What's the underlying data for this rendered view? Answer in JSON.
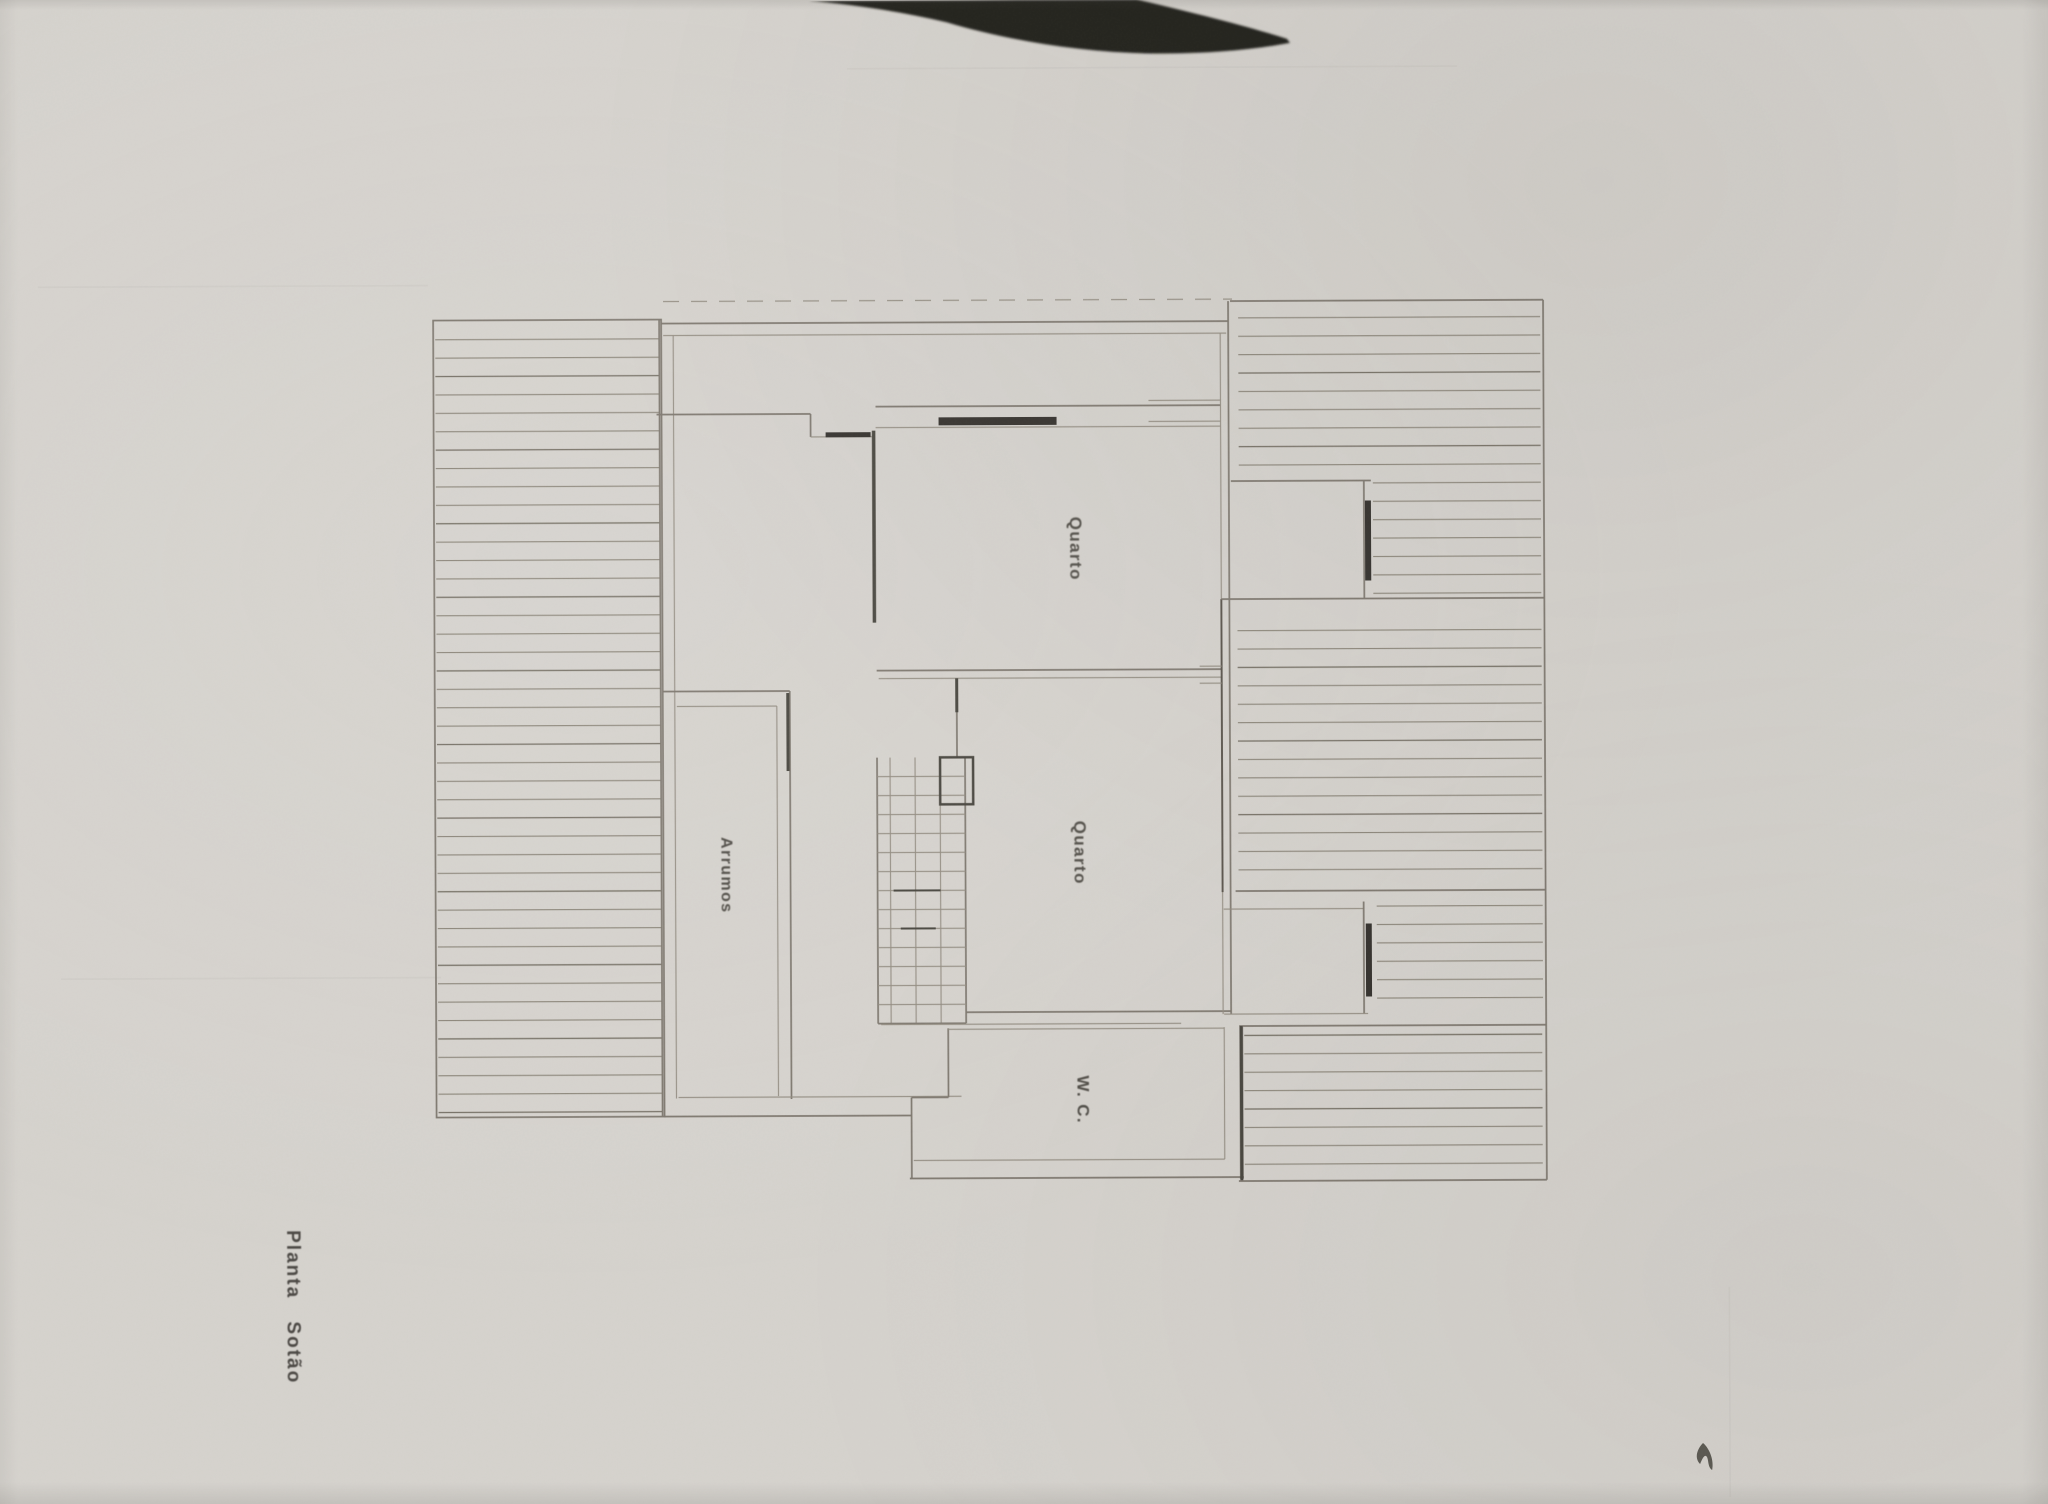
{
  "plan": {
    "title": "Planta Sotão",
    "rooms": [
      {
        "name": "quarto-top",
        "label": "Quarto"
      },
      {
        "name": "quarto-middle",
        "label": "Quarto"
      },
      {
        "name": "wc",
        "label": "W. C."
      },
      {
        "name": "arrumos",
        "label": "Arrumos"
      }
    ]
  },
  "colors": {
    "paper": "#d6d3ce",
    "wall_line": "#7f7970",
    "hatch_line": "#8b8579",
    "dark_mark": "#35322d",
    "label_text": "#514e48",
    "scanner_shadow": "#22201d"
  }
}
